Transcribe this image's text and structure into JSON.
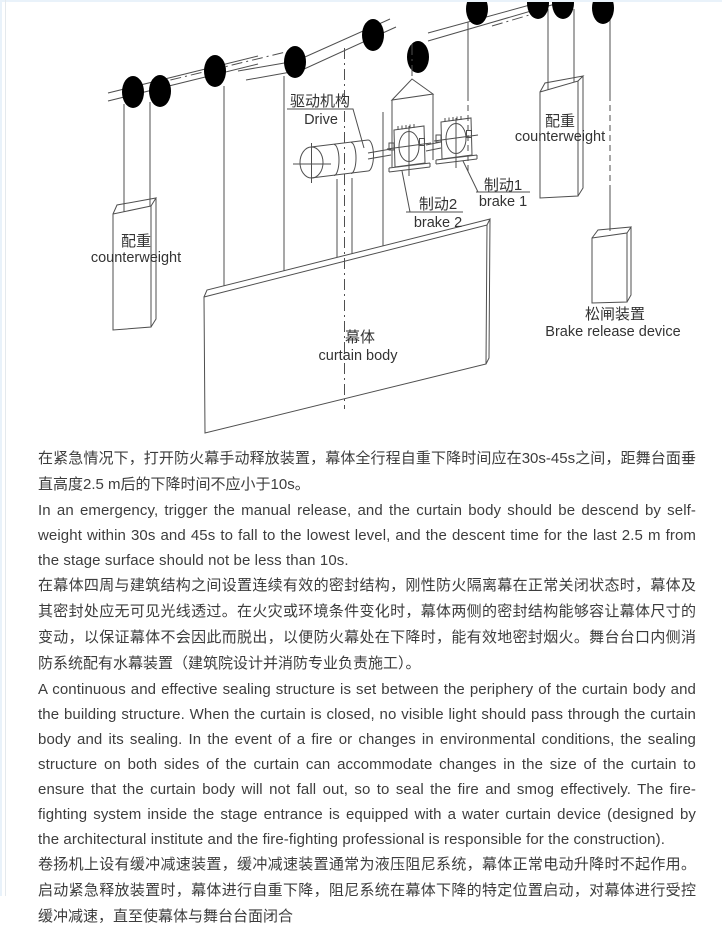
{
  "diagram": {
    "line_color": "#4f4f4f",
    "labels": {
      "drive_cn": "驱动机构",
      "drive_en": "Drive",
      "counterweight_left_cn": "配重",
      "counterweight_left_en": "counterweight",
      "counterweight_right_cn": "配重",
      "counterweight_right_en": "counterweight",
      "brake1_cn": "制动1",
      "brake1_en": "brake 1",
      "brake2_cn": "制动2",
      "brake2_en": "brake 2",
      "curtain_cn": "幕体",
      "curtain_en": "curtain body",
      "brake_release_cn": "松闸装置",
      "brake_release_en": "Brake release device"
    }
  },
  "paragraphs": [
    {
      "lang": "zh",
      "text": "在紧急情况下，打开防火幕手动释放装置，幕体全行程自重下降时间应在30s-45s之间，距舞台面垂直高度2.5 m后的下降时间不应小于10s。"
    },
    {
      "lang": "en",
      "text": "In an emergency, trigger the manual release, and the curtain body should be descend by self-weight within 30s and 45s to fall to the lowest level, and the descent time for the last 2.5 m from the stage surface should not be less than 10s."
    },
    {
      "lang": "zh",
      "text": "在幕体四周与建筑结构之间设置连续有效的密封结构，刚性防火隔离幕在正常关闭状态时，幕体及其密封处应无可见光线透过。在火灾或环境条件变化时，幕体两侧的密封结构能够容让幕体尺寸的变动，以保证幕体不会因此而脱出，以便防火幕处在下降时，能有效地密封烟火。舞台台口内侧消防系统配有水幕装置（建筑院设计并消防专业负责施工）。"
    },
    {
      "lang": "en",
      "text": "A continuous and effective sealing structure is set between the periphery of the curtain body and the building structure. When the curtain is closed, no visible light should pass through the curtain body and its sealing. In the event of a fire or changes in environmental conditions, the sealing structure on both sides of the curtain can accommodate changes in the size of the curtain to ensure that the curtain body will not fall out, so to seal the fire and smog effectively. The fire-fighting system inside the stage entrance is equipped with a water curtain device (designed by the architectural institute and the fire-fighting professional is responsible for the construction)."
    },
    {
      "lang": "zh",
      "text": "卷扬机上设有缓冲减速装置，缓冲减速装置通常为液压阻尼系统，幕体正常电动升降时不起作用。启动紧急释放装置时，幕体进行自重下降，阻尼系统在幕体下降的特定位置启动，对幕体进行受控缓冲减速，直至使幕体与舞台台面闭合"
    }
  ]
}
